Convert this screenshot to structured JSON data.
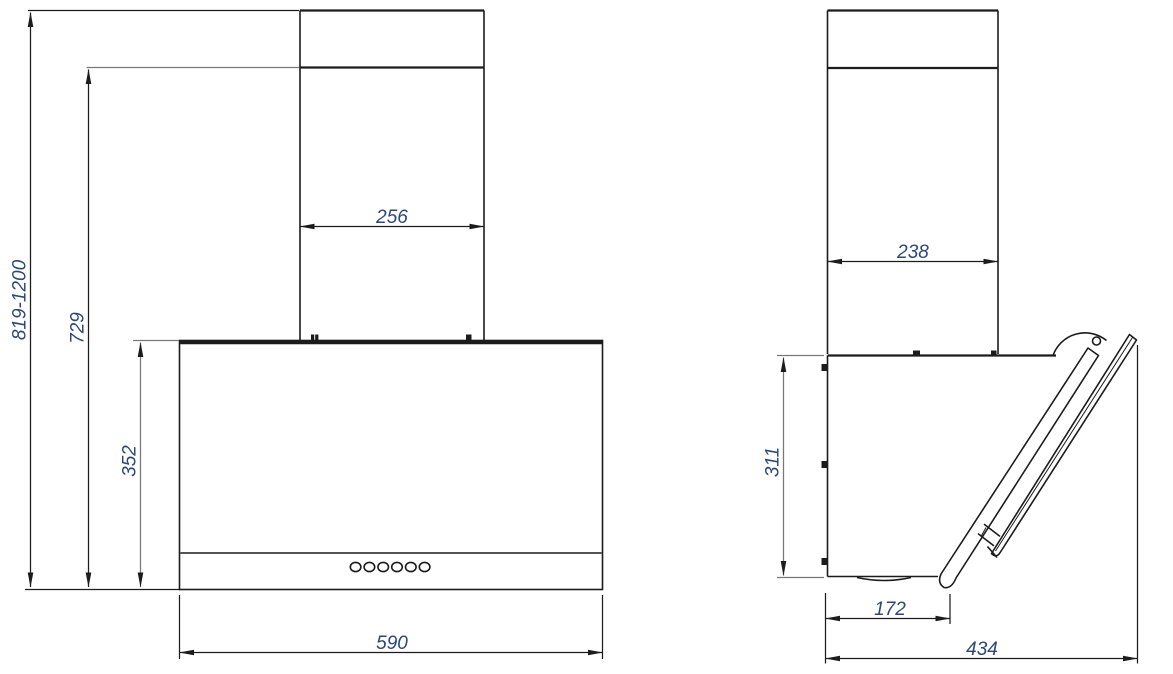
{
  "drawing": {
    "kind": "technical dimension drawing",
    "subject": "wall-mounted inclined kitchen hood, front and side views",
    "colors": {
      "background": "#ffffff",
      "object_line": "#1c1c1c",
      "dim_line": "#787878",
      "dim_text": "#2c4878"
    },
    "front_view": {
      "name": "front view",
      "control_buttons": 6,
      "dimensions": {
        "overall_height_range": "819-1200",
        "height_to_duct_joint": "729",
        "body_height": "352",
        "duct_width": "256",
        "body_width": "590"
      }
    },
    "side_view": {
      "name": "side view",
      "dimensions": {
        "duct_depth": "238",
        "body_height": "311",
        "bottom_depth": "172",
        "overall_depth": "434"
      }
    }
  }
}
